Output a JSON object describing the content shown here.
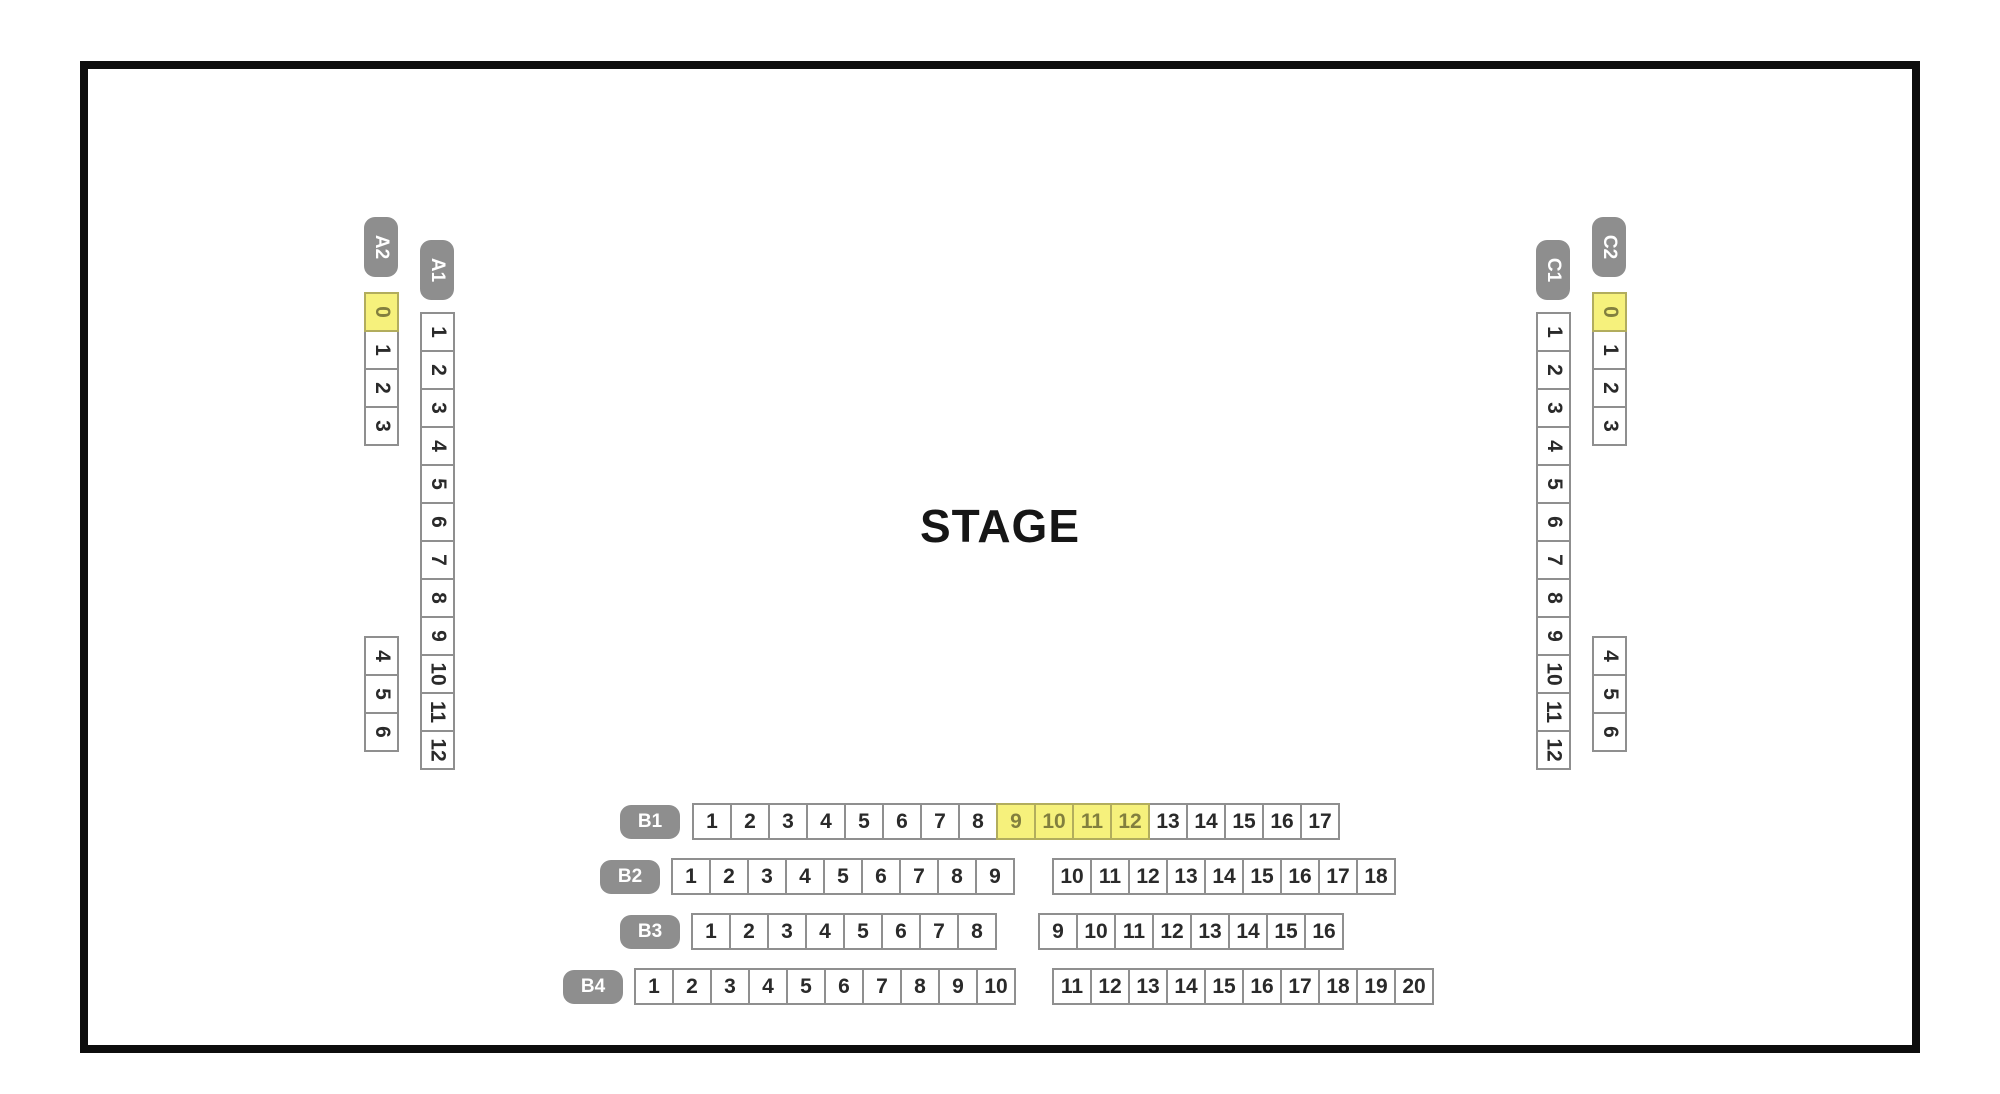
{
  "stage_label": "STAGE",
  "colors": {
    "outline": "#0d0d0d",
    "section_label_bg": "#8e8e8e",
    "section_label_text": "#ffffff",
    "seat_bg": "#ffffff",
    "seat_border": "#8f8f8f",
    "seat_text": "#2a2a2a",
    "selected_seat_bg": "#f6f17c",
    "selected_seat_border": "#b2ad5d",
    "selected_seat_text": "#827f3e"
  },
  "side_sections": [
    {
      "id": "A2",
      "label": "A2",
      "x": 364,
      "label_y": 217,
      "groups": [
        {
          "y": 292,
          "seats": [
            "0",
            "1",
            "2",
            "3"
          ],
          "selected": [
            "0"
          ]
        },
        {
          "y": 636,
          "seats": [
            "4",
            "5",
            "6"
          ],
          "selected": []
        }
      ]
    },
    {
      "id": "A1",
      "label": "A1",
      "x": 420,
      "label_y": 240,
      "groups": [
        {
          "y": 312,
          "seats": [
            "1",
            "2",
            "3",
            "4",
            "5",
            "6",
            "7",
            "8",
            "9",
            "10",
            "11",
            "12"
          ],
          "selected": []
        }
      ]
    },
    {
      "id": "C1",
      "label": "C1",
      "x": 1536,
      "label_y": 240,
      "groups": [
        {
          "y": 312,
          "seats": [
            "1",
            "2",
            "3",
            "4",
            "5",
            "6",
            "7",
            "8",
            "9",
            "10",
            "11",
            "12"
          ],
          "selected": []
        }
      ]
    },
    {
      "id": "C2",
      "label": "C2",
      "x": 1592,
      "label_y": 217,
      "groups": [
        {
          "y": 292,
          "seats": [
            "0",
            "1",
            "2",
            "3"
          ],
          "selected": [
            "0"
          ]
        },
        {
          "y": 636,
          "seats": [
            "4",
            "5",
            "6"
          ],
          "selected": []
        }
      ]
    }
  ],
  "bottom_rows": [
    {
      "id": "B1",
      "label": "B1",
      "y": 803,
      "label_x": 620,
      "groups": [
        {
          "x": 692,
          "seats": [
            "1",
            "2",
            "3",
            "4",
            "5",
            "6",
            "7",
            "8",
            "9",
            "10",
            "11",
            "12",
            "13",
            "14",
            "15",
            "16",
            "17"
          ],
          "selected": [
            "9",
            "10",
            "11",
            "12"
          ]
        }
      ]
    },
    {
      "id": "B2",
      "label": "B2",
      "y": 858,
      "label_x": 600,
      "groups": [
        {
          "x": 671,
          "seats": [
            "1",
            "2",
            "3",
            "4",
            "5",
            "6",
            "7",
            "8",
            "9"
          ],
          "selected": []
        },
        {
          "x": 1052,
          "seats": [
            "10",
            "11",
            "12",
            "13",
            "14",
            "15",
            "16",
            "17",
            "18"
          ],
          "selected": []
        }
      ]
    },
    {
      "id": "B3",
      "label": "B3",
      "y": 913,
      "label_x": 620,
      "groups": [
        {
          "x": 691,
          "seats": [
            "1",
            "2",
            "3",
            "4",
            "5",
            "6",
            "7",
            "8"
          ],
          "selected": []
        },
        {
          "x": 1038,
          "seats": [
            "9",
            "10",
            "11",
            "12",
            "13",
            "14",
            "15",
            "16"
          ],
          "selected": []
        }
      ]
    },
    {
      "id": "B4",
      "label": "B4",
      "y": 968,
      "label_x": 563,
      "groups": [
        {
          "x": 634,
          "seats": [
            "1",
            "2",
            "3",
            "4",
            "5",
            "6",
            "7",
            "8",
            "9",
            "10"
          ],
          "selected": []
        },
        {
          "x": 1052,
          "seats": [
            "11",
            "12",
            "13",
            "14",
            "15",
            "16",
            "17",
            "18",
            "19",
            "20"
          ],
          "selected": []
        }
      ]
    }
  ]
}
